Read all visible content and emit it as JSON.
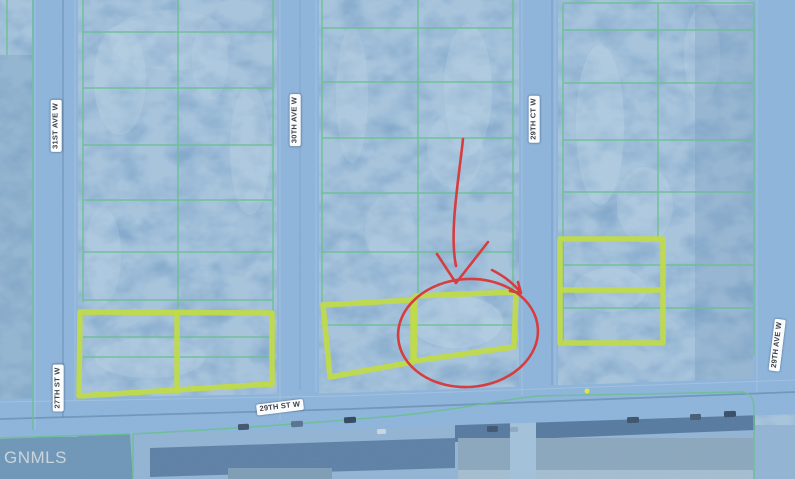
{
  "map": {
    "type": "aerial-parcel-map",
    "attribution": "GNMLS",
    "streets": [
      {
        "id": "31st-ave-w",
        "label": "31ST AVE W",
        "orientation": "vertical"
      },
      {
        "id": "30th-ave-w",
        "label": "30TH AVE W",
        "orientation": "vertical"
      },
      {
        "id": "29th-ct-w",
        "label": "29TH CT W",
        "orientation": "vertical"
      },
      {
        "id": "29th-ave-w",
        "label": "29TH AVE W",
        "orientation": "vertical"
      },
      {
        "id": "27th-st-w",
        "label": "27TH ST W",
        "orientation": "vertical"
      },
      {
        "id": "29th-st-w",
        "label": "29TH ST W",
        "orientation": "horizontal"
      }
    ],
    "annotation": {
      "type": "hand-drawn arrow and circle marking a lot",
      "color": "#dc3232"
    },
    "colors": {
      "parcel_line": "#67c18d",
      "highlight_outline": "#c4de3d",
      "annotation": "#dc3232",
      "field": "#7da4c9",
      "street": "#8fb5dc",
      "label_text": "#3b4148",
      "watermark": "#d2dae0"
    }
  }
}
